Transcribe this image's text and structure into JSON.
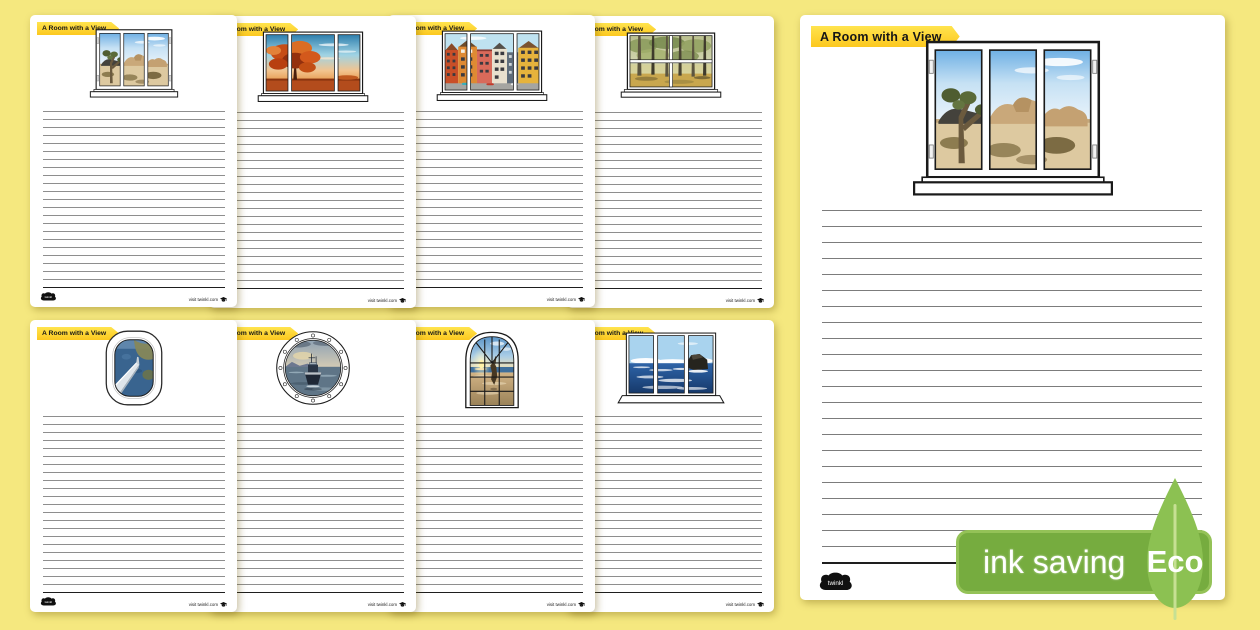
{
  "background_color": "#f5e87f",
  "title": "A Room with a View",
  "banner": {
    "color_top": "#ffe44e",
    "color_bottom": "#fcc81f",
    "text_color": "#161616"
  },
  "footer": {
    "visit_text": "visit twinkl.com",
    "logo_text": "twinkl"
  },
  "eco_badge": {
    "label": "ink saving",
    "eco": "Eco",
    "badge_color": "#76ac3f",
    "leaf_color": "#8cc152"
  },
  "pages": [
    {
      "window": "desert-joshua-tree-window",
      "scene": "desert",
      "type": "casement3",
      "size": "small"
    },
    {
      "window": "autumn-tree-window",
      "scene": "autumn",
      "type": "casement3wide",
      "size": "small"
    },
    {
      "window": "colourful-townhouses-window",
      "scene": "houses",
      "type": "casement3wide",
      "size": "small"
    },
    {
      "window": "forest-sash-window",
      "scene": "forest",
      "type": "sash4",
      "size": "small"
    },
    {
      "window": "aeroplane-window",
      "scene": "plane",
      "type": "plane",
      "size": "small"
    },
    {
      "window": "ship-porthole-window",
      "scene": "ship",
      "type": "porthole",
      "size": "small"
    },
    {
      "window": "sunset-beach-arched-window",
      "scene": "beach",
      "type": "arch",
      "size": "small"
    },
    {
      "window": "ocean-rocks-window",
      "scene": "ocean",
      "type": "ocean3",
      "size": "small"
    },
    {
      "window": "desert-joshua-tree-window-large",
      "scene": "desert",
      "type": "casement3",
      "size": "big"
    }
  ]
}
